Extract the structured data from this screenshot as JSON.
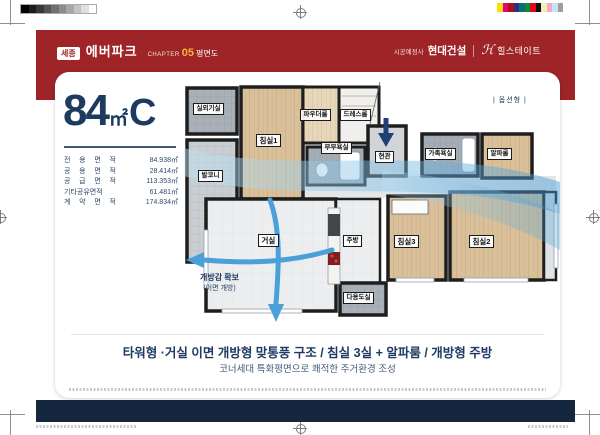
{
  "header": {
    "region_badge": "세종",
    "brand": "에버파크",
    "chapter_label": "CHAPTER",
    "chapter_number": "05",
    "chapter_title": "평면도",
    "builder_prefix": "시공예정사",
    "builder": "현대건설",
    "brand2_mark": "ℋ",
    "brand2": "힐스테이트"
  },
  "unit": {
    "size_number": "84",
    "size_unit": "㎡",
    "size_type": "C",
    "areas": [
      {
        "label": "전 용 면 적",
        "value": "84.938㎡"
      },
      {
        "label": "공 용 면 적",
        "value": "28.414㎡"
      },
      {
        "label": "공 급 면 적",
        "value": "113.353㎡"
      },
      {
        "label": "기타공유면적",
        "value": "61.481㎡"
      },
      {
        "label": "계 약 면 적",
        "value": "174.834㎡"
      }
    ]
  },
  "plan": {
    "option_label": "| 옵션형 |",
    "rooms": [
      {
        "id": "outdoor-unit-room",
        "label": "실외기실"
      },
      {
        "id": "balcony",
        "label": "발코니"
      },
      {
        "id": "bedroom1",
        "label": "침실1"
      },
      {
        "id": "powder-room",
        "label": "파우더룸"
      },
      {
        "id": "dress-room",
        "label": "드레스룸"
      },
      {
        "id": "master-bathroom",
        "label": "부부욕실"
      },
      {
        "id": "entrance",
        "label": "현관"
      },
      {
        "id": "family-bathroom",
        "label": "가족욕실"
      },
      {
        "id": "alpha-room",
        "label": "알파룸"
      },
      {
        "id": "living-room",
        "label": "거실"
      },
      {
        "id": "kitchen",
        "label": "주방"
      },
      {
        "id": "utility-room",
        "label": "다용도실"
      },
      {
        "id": "bedroom3",
        "label": "침실3"
      },
      {
        "id": "bedroom2",
        "label": "침실2"
      }
    ],
    "airflow_note": {
      "line1": "개방감 확보",
      "line2": "(이면 개방)"
    }
  },
  "footer": {
    "headline": "타워형 ·거실 이면 개방형 맞통풍 구조 / 침실 3실 + 알파룸 / 개방형 주방",
    "subline": "코너세대 특화평면으로 쾌적한 주거환경 조성"
  },
  "colors": {
    "header_red": "#9e2428",
    "footer_navy": "#15273f",
    "accent_navy": "#1d3a5f",
    "chapter_yellow": "#f3b73a",
    "flow_blue": "#4aa0d8",
    "wood_floor": "#d9c09a",
    "tile_gray": "#c9ced2"
  },
  "print_marks": {
    "grayscale_bar": [
      "#000000",
      "#1c1c1c",
      "#383838",
      "#545454",
      "#707070",
      "#8c8c8c",
      "#a8a8a8",
      "#c4c4c4",
      "#e0e0e0",
      "#ffffff"
    ],
    "color_bar": [
      "#f5e400",
      "#e6007e",
      "#b01116",
      "#2d2f87",
      "#0c6e6f",
      "#12883e",
      "#e30613",
      "#111111",
      "#f4ecb0",
      "#f5a9c4",
      "#c3e6f0",
      "#9d9d9c"
    ]
  }
}
